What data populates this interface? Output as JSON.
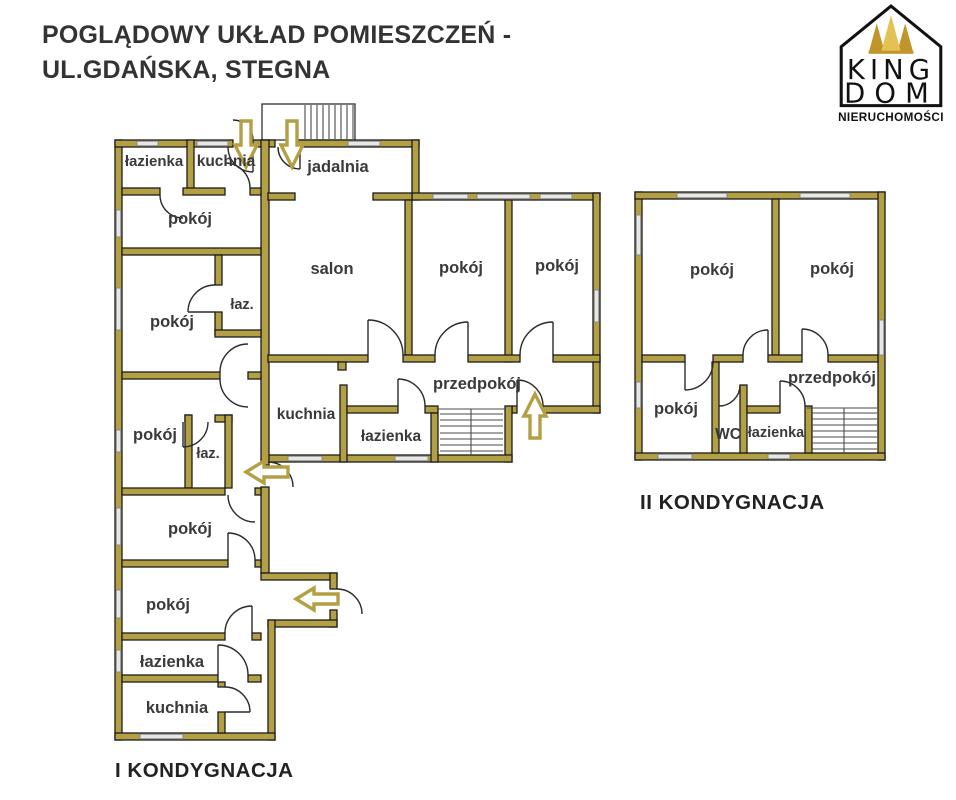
{
  "header": {
    "title_line1": "POGLĄDOWY UKŁAD POMIESZCZEŃ -",
    "title_line2": "UL.GDAŃSKA, STEGNA"
  },
  "logo": {
    "brand_line1": "KING",
    "brand_line2": "DOM",
    "subtitle": "NIERUCHOMOŚCI"
  },
  "floor1": {
    "caption": "I KONDYGNACJA",
    "rooms": {
      "lazienka_top": "łazienka",
      "kuchnia_top": "kuchnia",
      "jadalnia": "jadalnia",
      "pokoj_top": "pokój",
      "salon": "salon",
      "pokoj_mid1": "pokój",
      "pokoj_mid2": "pokój",
      "pokoj_left1": "pokój",
      "laz_1": "łaz.",
      "pokoj_left2": "pokój",
      "laz_2": "łaz.",
      "przedpokoj": "przedpokój",
      "kuchnia_mid": "kuchnia",
      "lazienka_mid": "łazienka",
      "pokoj_low1": "pokój",
      "pokoj_low2": "pokój",
      "lazienka_low": "łazienka",
      "kuchnia_low": "kuchnia"
    }
  },
  "floor2": {
    "caption": "II KONDYGNACJA",
    "rooms": {
      "pokoj_left": "pokój",
      "pokoj_right": "pokój",
      "przedpokoj": "przedpokój",
      "pokoj_low": "pokój",
      "wc": "WC",
      "lazienka": "łazienka"
    }
  },
  "colors": {
    "wall": "#b39f44",
    "wall_outline": "#1c1c1c",
    "arrow": "#b39f44",
    "label_text": "#3a3a3a",
    "crown_gold_dark": "#c2952c",
    "crown_gold_light": "#e4c153"
  }
}
